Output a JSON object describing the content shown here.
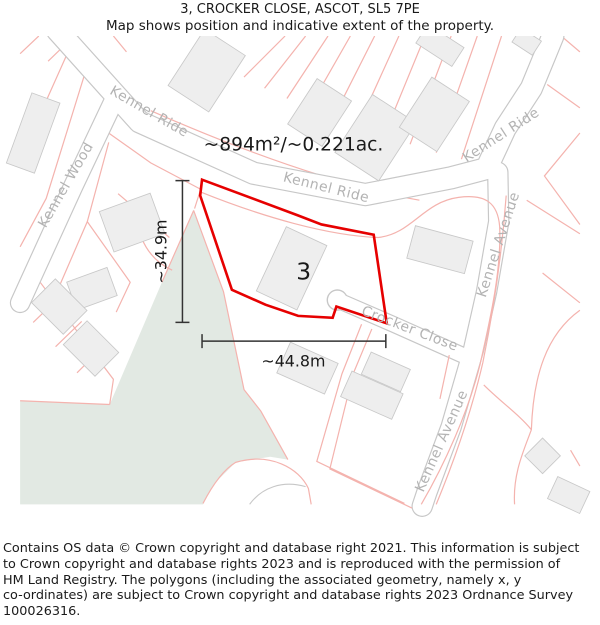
{
  "header": {
    "title": "3, CROCKER CLOSE, ASCOT, SL5 7PE",
    "subtitle": "Map shows position and indicative extent of the property."
  },
  "map": {
    "area_label": "~894m²/~0.221ac.",
    "plot_number": "3",
    "dim_width": "~44.8m",
    "dim_height": "~34.9m",
    "streets": {
      "kennel_ride": "Kennel Ride",
      "kennel_wood": "Kennel Wood",
      "kennel_avenue": "Kennel Avenue",
      "crocker_close": "Crocker Close"
    },
    "colors": {
      "property_outline": "#e60000",
      "parcel_line": "#f4b3ae",
      "road_casing": "#c7c7c7",
      "road_fill": "#ffffff",
      "building_fill": "#eeeeee",
      "building_stroke": "#c8c8c8",
      "woodland_fill": "#e2e9e3",
      "street_label": "#b3b3b3",
      "dimension_line": "#333333"
    }
  },
  "footer": {
    "lines": [
      "Contains OS data © Crown copyright and database right 2021. This information is subject",
      "to Crown copyright and database rights 2023 and is reproduced with the permission of",
      "HM Land Registry. The polygons (including the associated geometry, namely x, y",
      "co-ordinates) are subject to Crown copyright and database rights 2023 Ordnance Survey",
      "100026316."
    ]
  }
}
